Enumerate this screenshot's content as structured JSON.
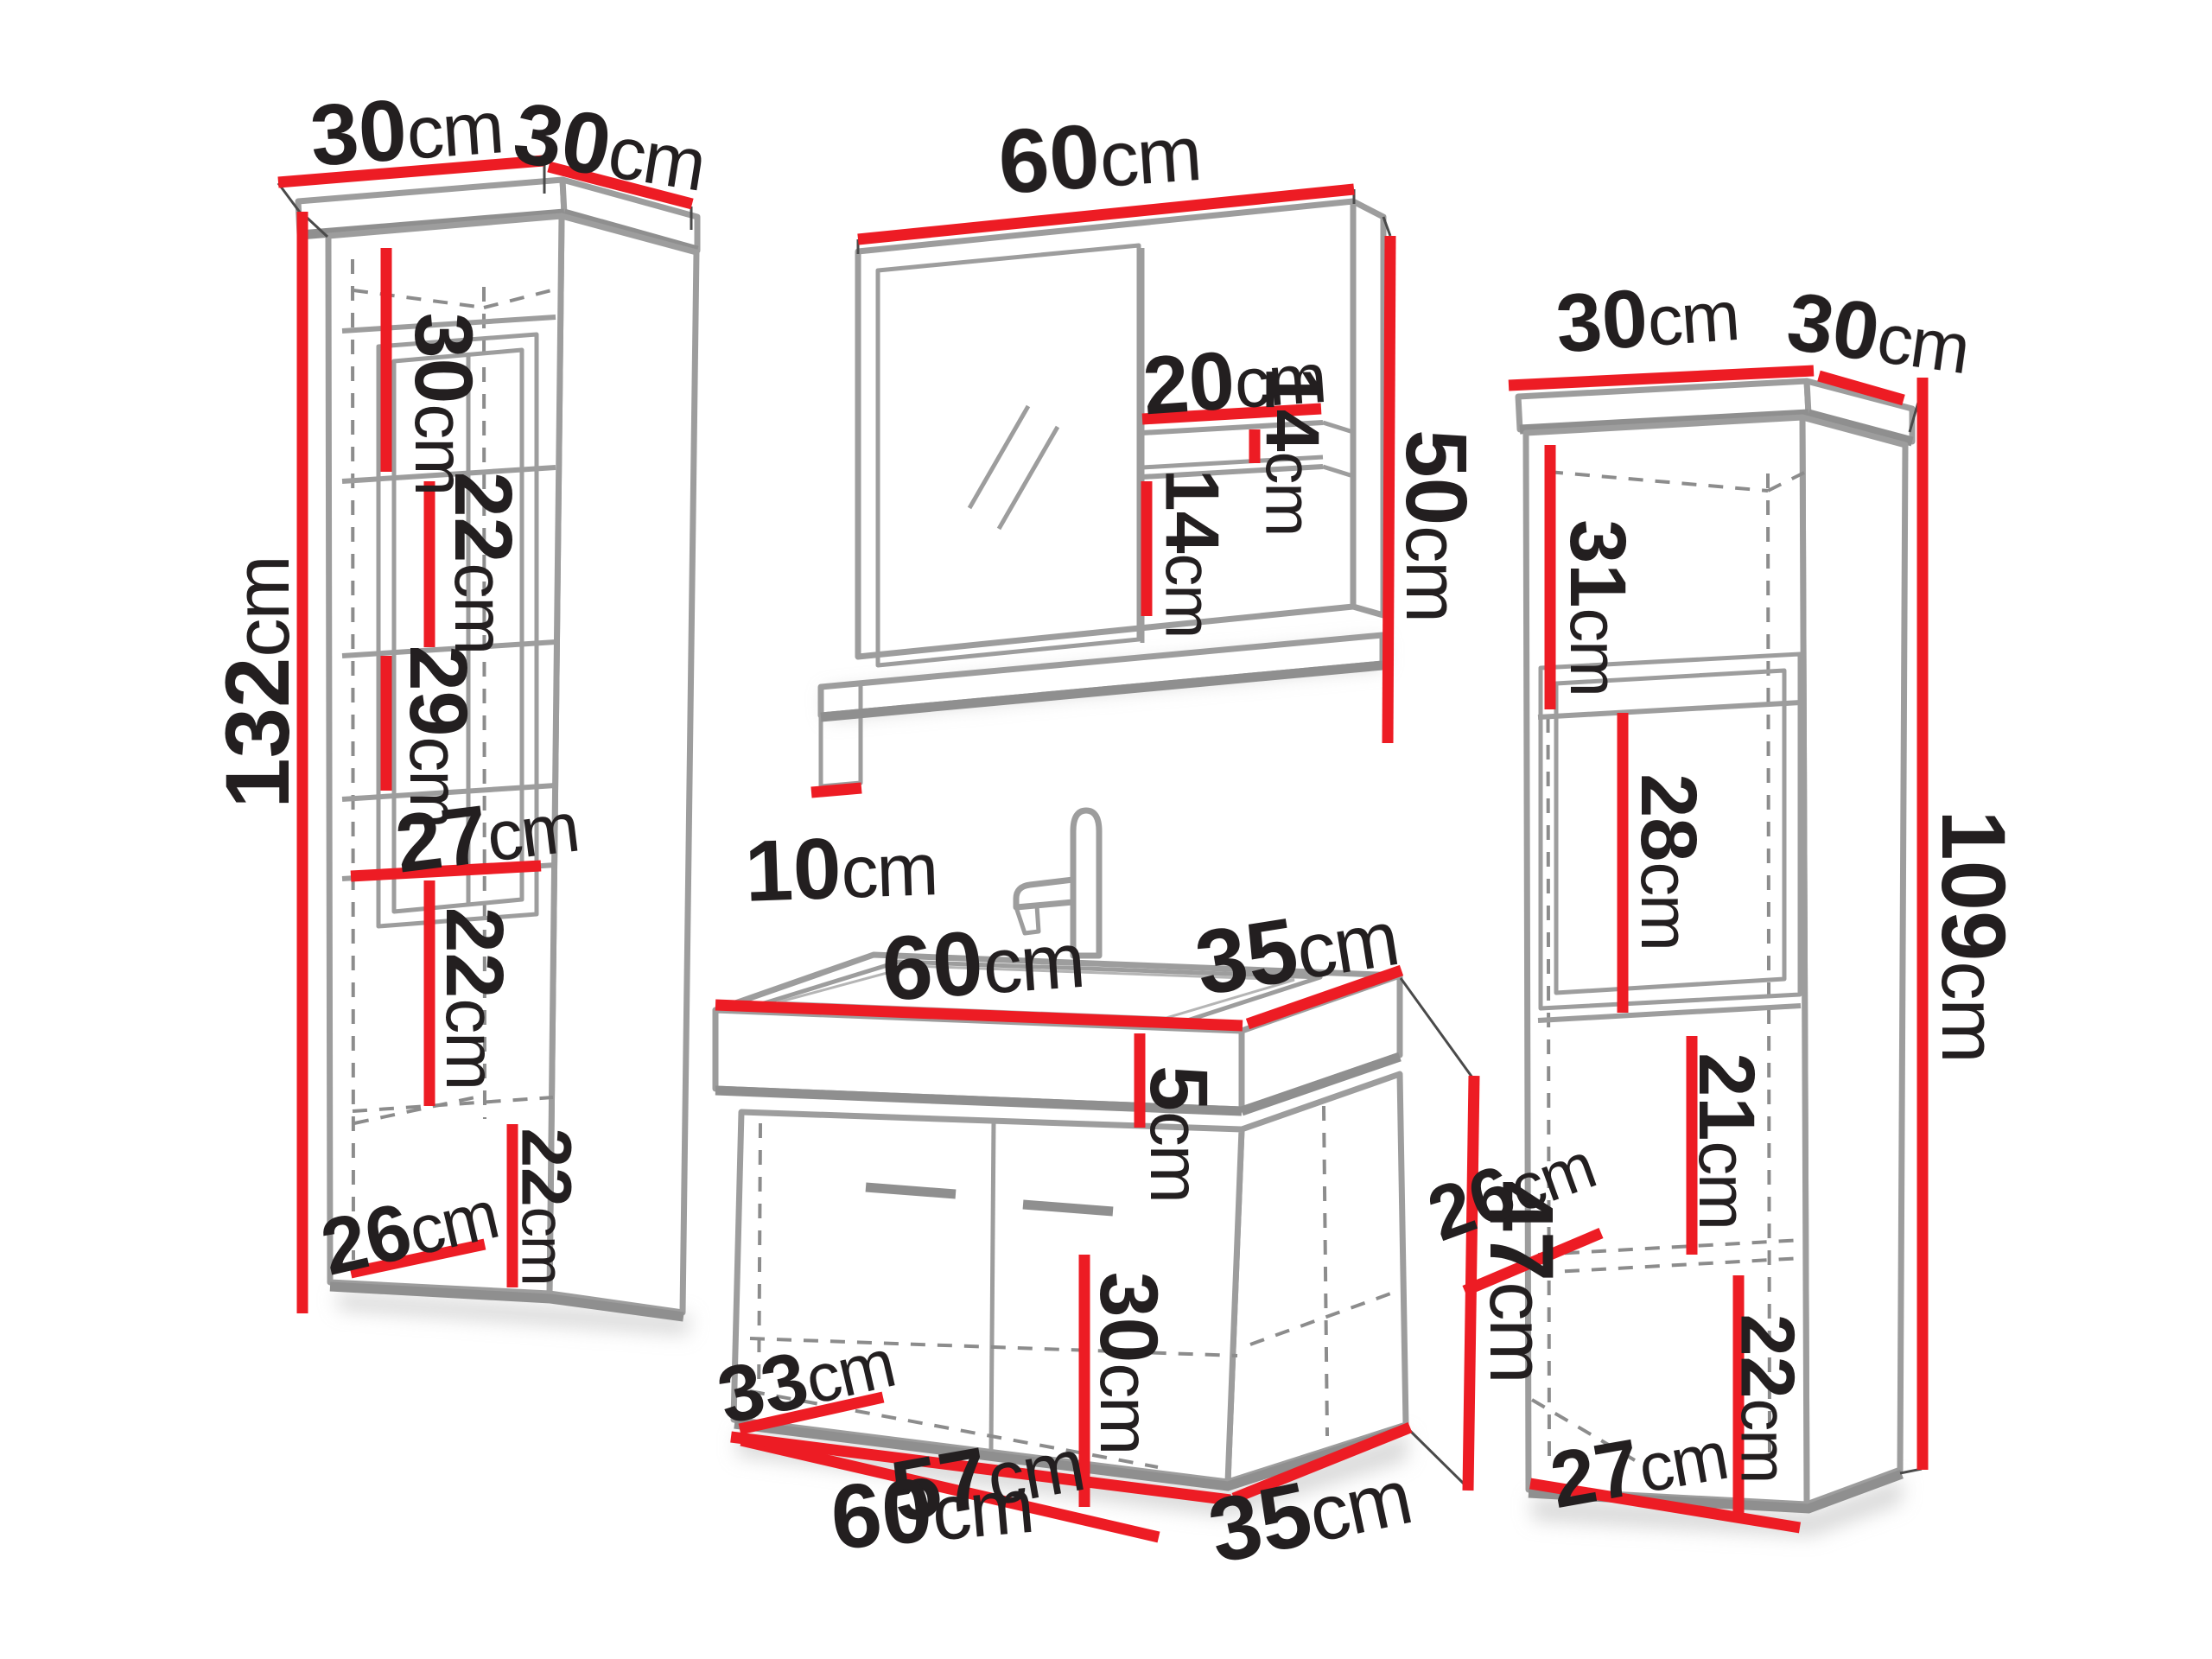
{
  "colors": {
    "dimension": "#ED1C24",
    "outline": "#9D9D9D",
    "shadow": "#8F8F8F",
    "text": "#231F20"
  },
  "diagram": {
    "left_cabinet": {
      "description": "tall column cabinet",
      "dims": {
        "top_width": "30cm",
        "top_depth": "30cm",
        "height": "132cm",
        "compartment_1": "30cm",
        "compartment_2": "22cm",
        "compartment_3": "29cm",
        "shelf_width": "27cm",
        "compartment_4": "22cm",
        "bottom_diagonal": "26cm",
        "side_compartment": "22cm"
      }
    },
    "mirror": {
      "description": "mirror with side shelves",
      "dims": {
        "width": "60cm",
        "shelf_width": "20cm",
        "shelf_gap_top": "14cm",
        "shelf_gap_bottom": "14cm",
        "height": "50cm",
        "ledge_depth": "10cm"
      }
    },
    "vanity": {
      "description": "washbasin cabinet",
      "dims": {
        "top_width": "60cm",
        "top_depth": "35cm",
        "basin_height": "5cm",
        "cabinet_height": "47cm",
        "inner_height": "30cm",
        "inner_depth": "33cm",
        "inner_width": "57cm",
        "bottom_width": "60cm",
        "bottom_depth": "35cm"
      }
    },
    "right_cabinet": {
      "description": "tall column cabinet",
      "dims": {
        "top_width": "30cm",
        "top_depth": "30cm",
        "height": "109cm",
        "compartment_1": "31cm",
        "compartment_2": "28cm",
        "inner_diagonal": "26cm",
        "compartment_3": "21cm",
        "compartment_4": "22cm",
        "bottom_width": "27cm"
      }
    }
  }
}
